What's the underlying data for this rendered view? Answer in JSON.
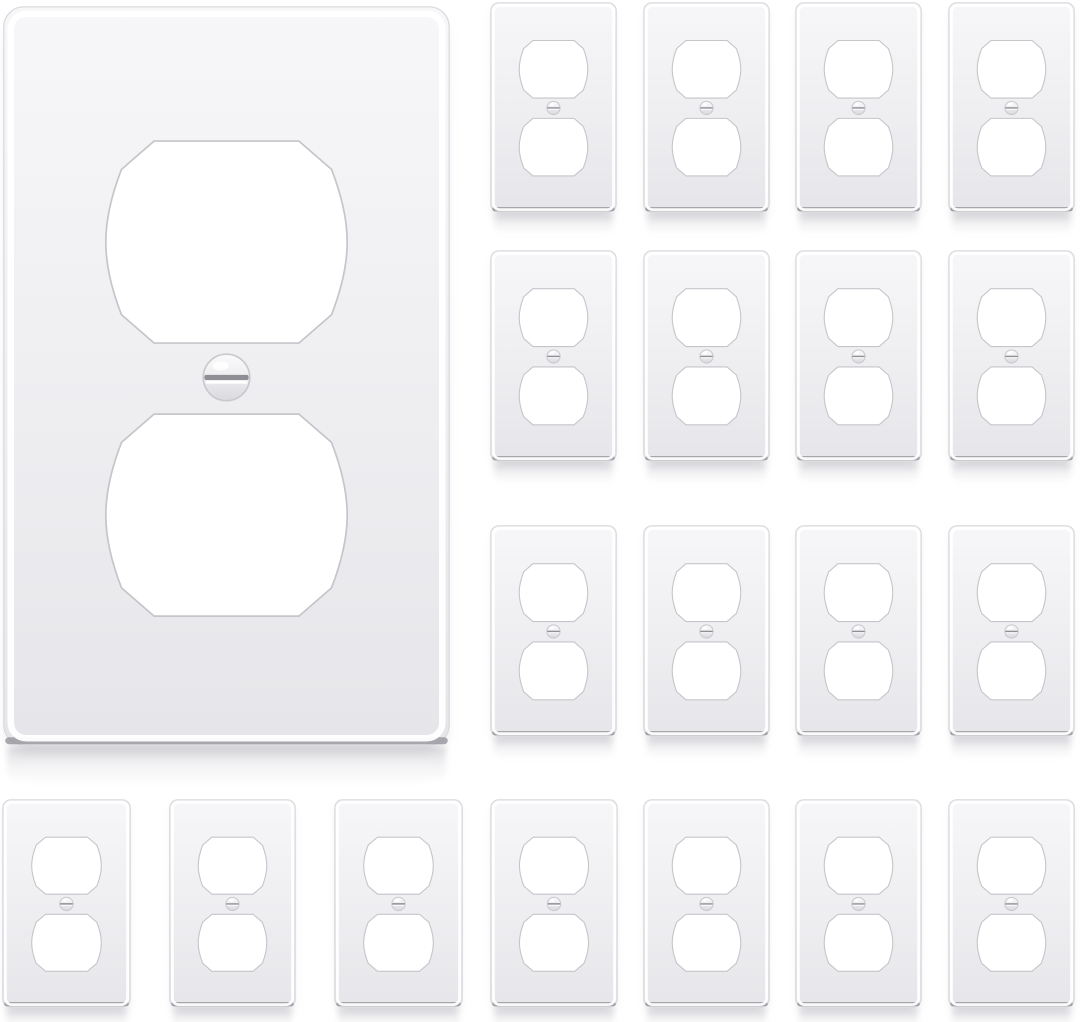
{
  "scene": {
    "description": "Product photo of white 1-gang duplex outlet wall plate covers on a white background",
    "background_color": "#ffffff",
    "counts": {
      "large_plates": 1,
      "small_plates": 19,
      "total_plates": 20
    }
  },
  "colors": {
    "background": "#ffffff",
    "plate_surface_top": "#f7f7f9",
    "plate_surface_mid": "#eeeef1",
    "plate_surface_bottom": "#e6e6ea",
    "plate_outline": "#d8d8dd",
    "plate_bevel_highlight": "#ffffff",
    "plate_bottom_edge": "#9a9aa1",
    "cutout_fill": "#ffffff",
    "cutout_outline": "#c5c5ca",
    "screw_top": "#fbfbfc",
    "screw_mid": "#ededf0",
    "screw_bottom": "#d9d9de",
    "screw_outline": "#c8c8cd",
    "screw_slot": "#8e8e94",
    "reflection": "#9d9da8"
  },
  "plate_geometry": {
    "cutout_center_x": 0.5,
    "upper_cutout_center_y": 0.319,
    "lower_cutout_center_y": 0.688,
    "screw_center_y": 0.502,
    "cutout_width_frac": 0.54,
    "cutout_height_frac": 0.273,
    "screw_radius_frac": 0.052
  },
  "plates": {
    "large": {
      "x": 3,
      "y": 6,
      "w": 447,
      "h": 740
    },
    "small": [
      {
        "x": 490,
        "y": 2,
        "w": 127,
        "h": 211
      },
      {
        "x": 643,
        "y": 2,
        "w": 127,
        "h": 211
      },
      {
        "x": 795,
        "y": 2,
        "w": 127,
        "h": 211
      },
      {
        "x": 948,
        "y": 2,
        "w": 127,
        "h": 211
      },
      {
        "x": 490,
        "y": 250,
        "w": 127,
        "h": 212
      },
      {
        "x": 643,
        "y": 250,
        "w": 127,
        "h": 212
      },
      {
        "x": 795,
        "y": 250,
        "w": 127,
        "h": 212
      },
      {
        "x": 948,
        "y": 250,
        "w": 127,
        "h": 212
      },
      {
        "x": 490,
        "y": 525,
        "w": 127,
        "h": 212
      },
      {
        "x": 643,
        "y": 525,
        "w": 127,
        "h": 212
      },
      {
        "x": 795,
        "y": 525,
        "w": 127,
        "h": 212
      },
      {
        "x": 948,
        "y": 525,
        "w": 127,
        "h": 212
      },
      {
        "x": 2,
        "y": 799,
        "w": 129,
        "h": 209
      },
      {
        "x": 169,
        "y": 799,
        "w": 127,
        "h": 209
      },
      {
        "x": 334,
        "y": 799,
        "w": 129,
        "h": 209
      },
      {
        "x": 490,
        "y": 799,
        "w": 128,
        "h": 209
      },
      {
        "x": 643,
        "y": 799,
        "w": 127,
        "h": 209
      },
      {
        "x": 795,
        "y": 799,
        "w": 127,
        "h": 209
      },
      {
        "x": 948,
        "y": 799,
        "w": 127,
        "h": 209
      }
    ]
  }
}
